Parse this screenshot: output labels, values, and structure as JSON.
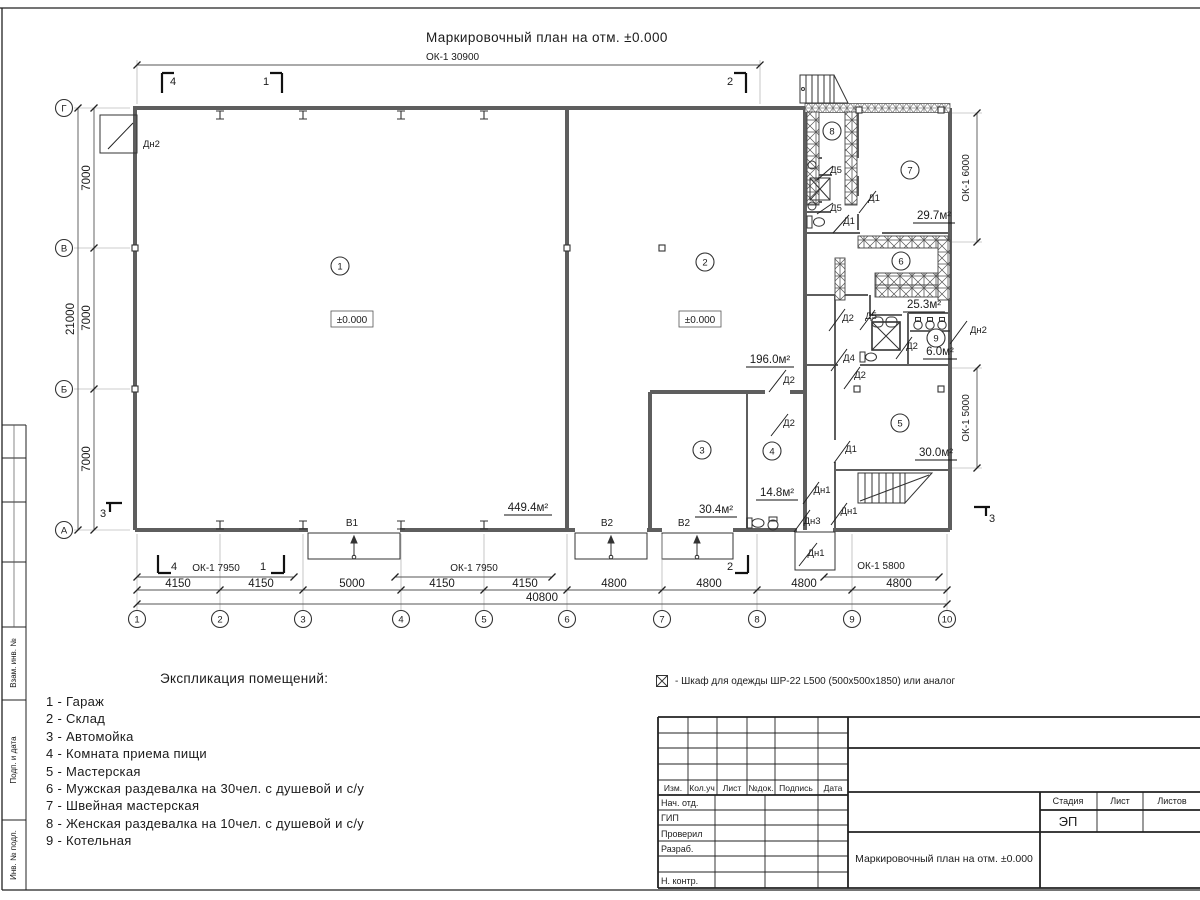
{
  "sheet": {
    "title": "Маркировочный план на отм. ±0.000",
    "top_window_dim": "ОК-1 30900"
  },
  "plan": {
    "grid_cols": [
      "1",
      "2",
      "3",
      "4",
      "5",
      "6",
      "7",
      "8",
      "9",
      "10"
    ],
    "grid_rows": [
      "Г",
      "В",
      "Б",
      "А"
    ],
    "dims_bottom": [
      "4150",
      "4150",
      "5000",
      "4150",
      "4150",
      "4800",
      "4800",
      "4800",
      "4800"
    ],
    "dim_total_bottom": "40800",
    "dims_left": [
      "7000",
      "7000",
      "7000"
    ],
    "dim_total_left": "21000",
    "window_dims": [
      "ОК-1 7950",
      "ОК-1 7950",
      "ОК-1 5800",
      "ОК-1 6000",
      "ОК-1 5000"
    ],
    "room_numbers": [
      "1",
      "2",
      "3",
      "4",
      "5",
      "6",
      "7",
      "8",
      "9"
    ],
    "area_labels": [
      "449.4м²",
      "196.0м²",
      "30.4м²",
      "14.8м²",
      "30.0м²",
      "25.3м²",
      "29.7м²",
      "6.0м²"
    ],
    "elevation_marks": [
      "±0.000",
      "±0.000"
    ],
    "door_labels": [
      "Дн2",
      "Д5",
      "Д5",
      "Д1",
      "Д1",
      "Д2",
      "Д5",
      "Дн2",
      "Д2",
      "Д4",
      "Д2",
      "Д2",
      "Д2",
      "Д1",
      "Дн1",
      "Дн1",
      "Дн3",
      "Дн1"
    ],
    "gate_labels": [
      "В1",
      "В2",
      "В2"
    ],
    "section_marks": [
      "4",
      "1",
      "2",
      "4",
      "1",
      "2",
      "3",
      "3"
    ]
  },
  "legend": {
    "title": "Экспликация помещений:",
    "items": [
      "1 - Гараж",
      "2 - Склад",
      "3 - Автомойка",
      "4 - Комната приема пищи",
      "5 - Мастерская",
      "6 - Мужская раздевалка на 30чел. с душевой и с/у",
      "7 - Швейная мастерская",
      "8 - Женская раздевалка на 10чел. с душевой и с/у",
      "9 - Котельная"
    ]
  },
  "note": {
    "text": "- Шкаф для одежды ШР-22 L500 (500x500x1850) или аналог"
  },
  "titleblock": {
    "rev_headers": [
      "Изм.",
      "Кол.уч",
      "Лист",
      "№док.",
      "Подпись",
      "Дата"
    ],
    "roles": [
      "Нач. отд.",
      "ГИП",
      "Проверил",
      "Разраб.",
      "Н. контр."
    ],
    "stage_headers": [
      "Стадия",
      "Лист",
      "Листов"
    ],
    "stage_value": "ЭП",
    "doc_title": "Маркировочный план на отм. ±0.000"
  },
  "frame": {
    "side_labels": [
      "Взам. инв. №",
      "Подп. и дата",
      "Инв. № подл."
    ]
  }
}
